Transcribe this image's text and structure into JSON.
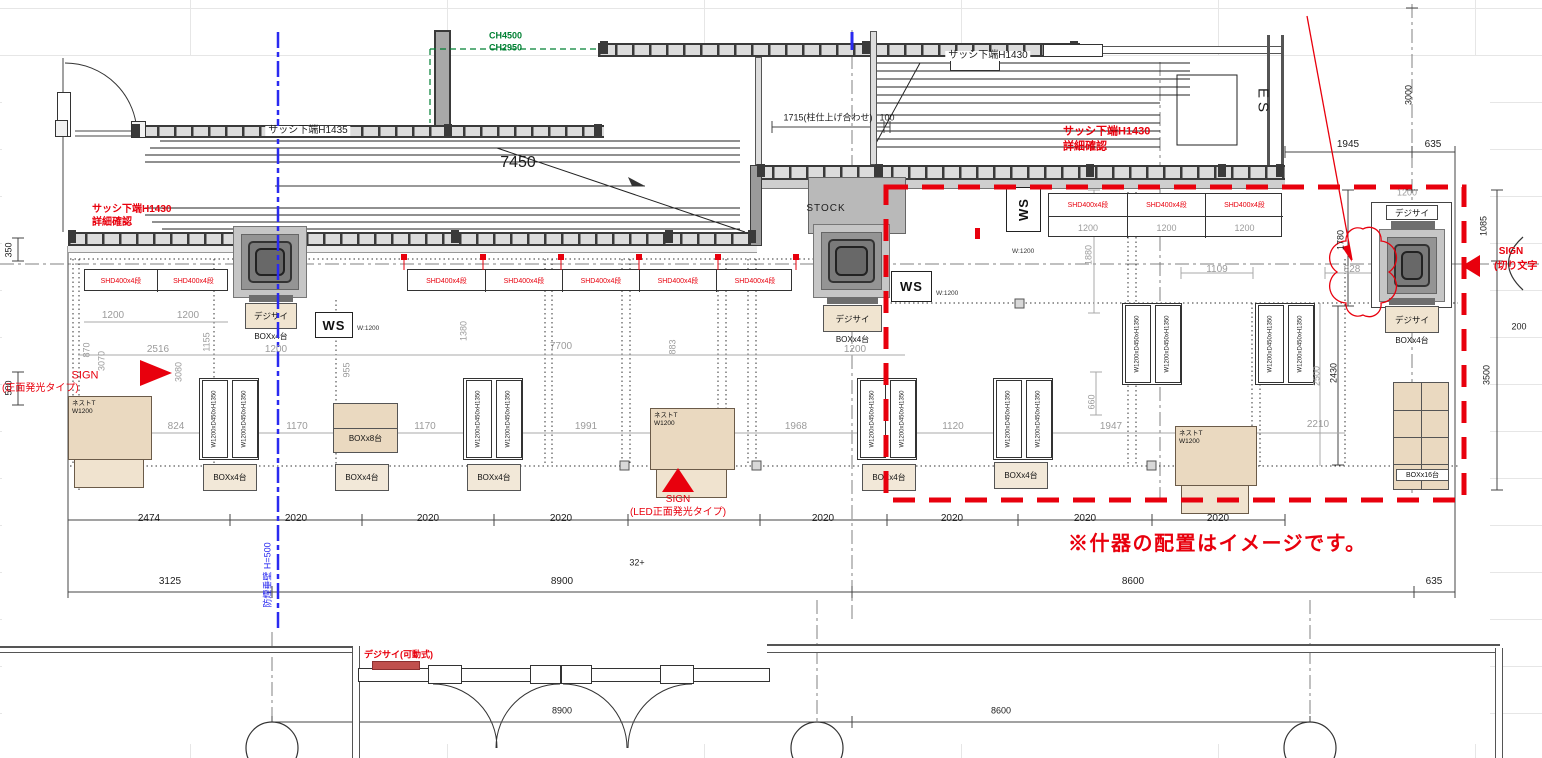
{
  "title_note": "※什器の配置はイメージです。",
  "colors": {
    "red": "#e8000d",
    "green": "#008033",
    "blue": "#2a2af0",
    "dim_gray": "#9b9b9b",
    "wall": "#3a3a3a",
    "tan": "#ead9c0"
  },
  "shelf_label": "SHD400x4段",
  "shelf_dim": "1200",
  "shelf_groups": [
    {
      "x": 84,
      "y": 269,
      "cols": 2,
      "w": 72,
      "dims": false
    },
    {
      "x": 407,
      "y": 269,
      "cols": 5,
      "w": 77,
      "dims": false
    },
    {
      "x": 1048,
      "y": 193,
      "cols": 3,
      "w": 78,
      "dims": true
    }
  ],
  "ws": {
    "label": "WS",
    "width_note": "W:1200",
    "units": [
      {
        "x": 315,
        "y": 312,
        "w": 38,
        "h": 26,
        "rot": false,
        "nx": 357,
        "ny": 325
      },
      {
        "x": 891,
        "y": 271,
        "w": 41,
        "h": 31,
        "rot": false,
        "nx": 936,
        "ny": 290
      },
      {
        "x": 1006,
        "y": 187,
        "w": 35,
        "h": 45,
        "rot": true,
        "nx": 1012,
        "ny": 248
      }
    ]
  },
  "fixture_label": "W1200xD450xH1350",
  "fixture_pairs": [
    {
      "x": 199,
      "y": 378
    },
    {
      "x": 463,
      "y": 378
    },
    {
      "x": 857,
      "y": 378
    },
    {
      "x": 993,
      "y": 378
    },
    {
      "x": 1122,
      "y": 303
    },
    {
      "x": 1255,
      "y": 303
    }
  ],
  "nest_label_1": "ネストT",
  "nest_label_2": "W1200",
  "nest_tables": [
    {
      "x": 68,
      "y": 396,
      "w": 84,
      "h": 64
    },
    {
      "x": 650,
      "y": 408,
      "w": 85,
      "h": 62
    },
    {
      "x": 1175,
      "y": 426,
      "w": 82,
      "h": 60
    }
  ],
  "box4_label": "BOXx4台",
  "box4_units": [
    {
      "x": 203,
      "y": 464
    },
    {
      "x": 335,
      "y": 464
    },
    {
      "x": 467,
      "y": 464
    },
    {
      "x": 862,
      "y": 464
    },
    {
      "x": 994,
      "y": 462
    }
  ],
  "box8": {
    "label": "BOXx8台",
    "x": 333,
    "y": 403,
    "w": 65,
    "h": 50
  },
  "box16": {
    "label": "BOXx16台",
    "x": 1393,
    "y": 382,
    "w": 56,
    "h": 108
  },
  "digisign_label": "デジサイ",
  "column_signage": [
    {
      "x": 245,
      "y": 303,
      "w": 52,
      "h": 26,
      "sub": "BOXx4台"
    },
    {
      "x": 823,
      "y": 305,
      "w": 59,
      "h": 27,
      "sub": "BOXx4台"
    },
    {
      "x": 1385,
      "y": 306,
      "w": 54,
      "h": 27,
      "sub": "BOXx4台"
    }
  ],
  "labels": [
    {
      "t": "サッシ下端H1435",
      "x": 308,
      "y": 131,
      "bg": 1
    },
    {
      "t": "サッシ下端H1430",
      "x": 988,
      "y": 56,
      "bg": 1
    },
    {
      "t": "7450",
      "x": 518,
      "y": 163,
      "s": 16
    },
    {
      "t": "1715(柱仕上げ合わせ)",
      "x": 828,
      "y": 118,
      "s": 9
    },
    {
      "t": "100",
      "x": 887,
      "y": 118,
      "s": 9
    },
    {
      "t": "1945",
      "x": 1348,
      "y": 145
    },
    {
      "t": "635",
      "x": 1433,
      "y": 145
    },
    {
      "t": "3000",
      "x": 1409,
      "y": 95,
      "s": 9,
      "r": -90
    },
    {
      "t": "STOCK",
      "x": 826,
      "y": 209,
      "ls": 1
    },
    {
      "t": "ES",
      "x": 1263,
      "y": 102,
      "s": 15,
      "r": 90,
      "ls": 4
    },
    {
      "t": "350",
      "x": 9,
      "y": 250,
      "s": 9,
      "r": -90
    },
    {
      "t": "500",
      "x": 9,
      "y": 388,
      "s": 9,
      "r": -90
    },
    {
      "t": "2474",
      "x": 149,
      "y": 519
    },
    {
      "t": "2020",
      "x": 296,
      "y": 519
    },
    {
      "t": "2020",
      "x": 428,
      "y": 519
    },
    {
      "t": "2020",
      "x": 561,
      "y": 519
    },
    {
      "t": "2020",
      "x": 823,
      "y": 519
    },
    {
      "t": "2020",
      "x": 952,
      "y": 519
    },
    {
      "t": "2020",
      "x": 1085,
      "y": 519
    },
    {
      "t": "2020",
      "x": 1218,
      "y": 519
    },
    {
      "t": "3125",
      "x": 170,
      "y": 582
    },
    {
      "t": "8900",
      "x": 562,
      "y": 582
    },
    {
      "t": "8600",
      "x": 1133,
      "y": 582
    },
    {
      "t": "635",
      "x": 1434,
      "y": 582
    },
    {
      "t": "8900",
      "x": 562,
      "y": 711,
      "s": 9
    },
    {
      "t": "8600",
      "x": 1001,
      "y": 711,
      "s": 9
    },
    {
      "t": "32+",
      "x": 637,
      "y": 563,
      "s": 9
    },
    {
      "t": "1780",
      "x": 1341,
      "y": 240,
      "s": 9,
      "r": -90
    },
    {
      "t": "1085",
      "x": 1484,
      "y": 226,
      "s": 9,
      "r": -90
    },
    {
      "t": "200",
      "x": 1519,
      "y": 327,
      "s": 9
    },
    {
      "t": "3500",
      "x": 1487,
      "y": 375,
      "s": 9,
      "r": -90
    },
    {
      "t": "2430",
      "x": 1334,
      "y": 373,
      "s": 9,
      "r": -90
    },
    {
      "t": "1200",
      "x": 113,
      "y": 316,
      "c": "g"
    },
    {
      "t": "1200",
      "x": 188,
      "y": 316,
      "c": "g"
    },
    {
      "t": "870",
      "x": 87,
      "y": 350,
      "c": "g",
      "s": 9,
      "r": -90
    },
    {
      "t": "2516",
      "x": 158,
      "y": 350,
      "c": "g"
    },
    {
      "t": "3070",
      "x": 102,
      "y": 361,
      "c": "g",
      "s": 9,
      "r": -90
    },
    {
      "t": "3080",
      "x": 179,
      "y": 372,
      "c": "g",
      "s": 9,
      "r": -90
    },
    {
      "t": "1155",
      "x": 207,
      "y": 342,
      "c": "g",
      "s": 9,
      "r": -90
    },
    {
      "t": "955",
      "x": 347,
      "y": 370,
      "c": "g",
      "s": 9,
      "r": -90
    },
    {
      "t": "1200",
      "x": 276,
      "y": 350,
      "c": "g"
    },
    {
      "t": "1200",
      "x": 855,
      "y": 350,
      "c": "g"
    },
    {
      "t": "824",
      "x": 176,
      "y": 427,
      "c": "g"
    },
    {
      "t": "1170",
      "x": 297,
      "y": 427,
      "c": "g"
    },
    {
      "t": "1170",
      "x": 425,
      "y": 427,
      "c": "g"
    },
    {
      "t": "1380",
      "x": 464,
      "y": 331,
      "c": "g",
      "s": 9,
      "r": -90
    },
    {
      "t": "7700",
      "x": 561,
      "y": 347,
      "c": "g"
    },
    {
      "t": "883",
      "x": 673,
      "y": 347,
      "c": "g",
      "s": 9,
      "r": -90
    },
    {
      "t": "1991",
      "x": 586,
      "y": 427,
      "c": "g"
    },
    {
      "t": "1968",
      "x": 796,
      "y": 427,
      "c": "g"
    },
    {
      "t": "1120",
      "x": 953,
      "y": 427,
      "c": "g"
    },
    {
      "t": "660",
      "x": 1092,
      "y": 402,
      "c": "g",
      "s": 9,
      "r": -90
    },
    {
      "t": "1947",
      "x": 1111,
      "y": 427,
      "c": "g"
    },
    {
      "t": "1109",
      "x": 1217,
      "y": 270,
      "c": "g"
    },
    {
      "t": "1880",
      "x": 1089,
      "y": 255,
      "c": "g",
      "s": 9,
      "r": -90
    },
    {
      "t": "828",
      "x": 1352,
      "y": 270,
      "c": "g"
    },
    {
      "t": "2500",
      "x": 1317,
      "y": 376,
      "c": "g",
      "s": 9,
      "r": -90
    },
    {
      "t": "2210",
      "x": 1318,
      "y": 425,
      "c": "g"
    },
    {
      "t": "1200",
      "x": 1407,
      "y": 193,
      "c": "g",
      "s": 9
    },
    {
      "t": "サッシ下端H1430",
      "x": 92,
      "y": 210,
      "c": "r",
      "a": "l",
      "b": 1
    },
    {
      "t": "詳細確認",
      "x": 92,
      "y": 223,
      "c": "r",
      "a": "l",
      "b": 1
    },
    {
      "t": "サッシ下端H1430",
      "x": 1063,
      "y": 132,
      "c": "r",
      "a": "l",
      "b": 1,
      "s": 11
    },
    {
      "t": "詳細確認",
      "x": 1063,
      "y": 147,
      "c": "r",
      "a": "l",
      "b": 1,
      "s": 11
    },
    {
      "t": "SIGN",
      "x": 85,
      "y": 376,
      "c": "r",
      "s": 11
    },
    {
      "t": "(正面発光タイプ)",
      "x": 2,
      "y": 389,
      "c": "r",
      "a": "l"
    },
    {
      "t": "SIGN",
      "x": 678,
      "y": 500,
      "c": "r"
    },
    {
      "t": "(LED正面発光タイプ)",
      "x": 678,
      "y": 513,
      "c": "r"
    },
    {
      "t": "デジサイ(可動式)",
      "x": 364,
      "y": 655,
      "c": "r",
      "a": "l",
      "s": 9,
      "b": 1
    },
    {
      "t": "SIGN",
      "x": 1511,
      "y": 252,
      "c": "r",
      "b": 1
    },
    {
      "t": "(切り文字",
      "x": 1494,
      "y": 267,
      "c": "r",
      "a": "l",
      "b": 1
    },
    {
      "t": "CH4500",
      "x": 489,
      "y": 36,
      "c": "gr",
      "a": "l",
      "s": 9,
      "b": 1
    },
    {
      "t": "CH2950",
      "x": 489,
      "y": 48,
      "c": "gr",
      "a": "l",
      "s": 9,
      "b": 1
    },
    {
      "t": "防煙垂壁 H=500",
      "x": 268,
      "y": 575,
      "c": "b",
      "s": 9,
      "r": -90
    }
  ]
}
